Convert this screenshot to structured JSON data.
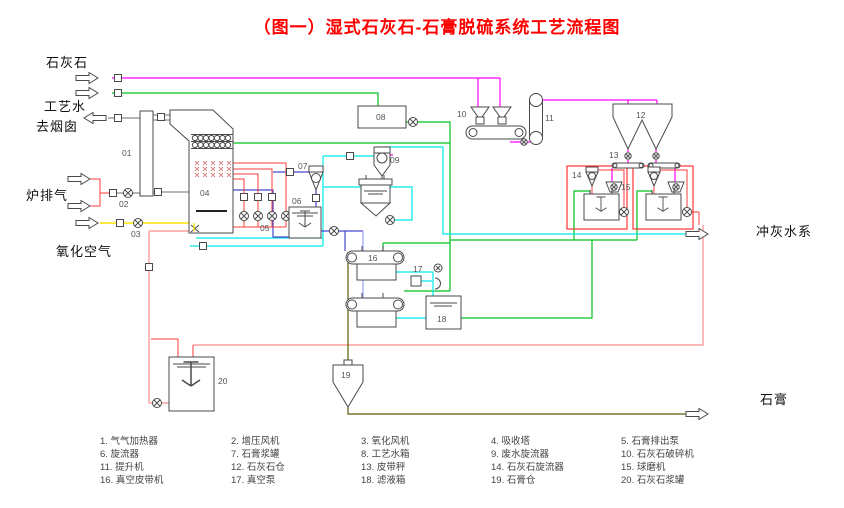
{
  "title": "（图一）湿式石灰石-石膏脱硫系统工艺流程图",
  "labels": {
    "limestone": "石灰石",
    "process_water": "工艺水",
    "to_chimney": "去烟囱",
    "furnace_exhaust": "炉排气",
    "oxidation_air": "氧化空气",
    "ash_water_system": "冲灰水系",
    "gypsum": "石膏"
  },
  "tags": {
    "t01": "01",
    "t02": "02",
    "t03": "03",
    "t04": "04",
    "t05": "05",
    "t06": "06",
    "t07": "07",
    "t08": "08",
    "t09": "09",
    "t10": "10",
    "t11": "11",
    "t12": "12",
    "t13": "13",
    "t14": "14",
    "t15": "15",
    "t16": "16",
    "t17": "17",
    "t18": "18",
    "t19": "19",
    "t20": "20"
  },
  "legend": {
    "items": [
      "1. 气气加热器",
      "2. 增压风机",
      "3. 氧化风机",
      "4. 吸收塔",
      "5. 石膏排出泵",
      "6. 旋流器",
      "7. 石膏浆罐",
      "8. 工艺水箱",
      "9. 废水旋流器",
      "10. 石灰石破碎机",
      "11. 提升机",
      "12. 石灰石仓",
      "13. 皮带秤",
      "14. 石灰石旋流器",
      "15. 球磨机",
      "16. 真空皮带机",
      "17. 真空泵",
      "18. 滤液箱",
      "19. 石膏仓",
      "20. 石灰石浆罐"
    ]
  },
  "colors": {
    "title_red": "#FF0000",
    "limestone_line": "#FF00FF",
    "process_water_line": "#00C020",
    "recycle_water_line": "#00E8E8",
    "slurry_line": "#4747D0",
    "oxidation_air_line": "#FFE400",
    "recirculation_line": "#FF3B3B",
    "slurry_feed_line": "#FF9E9E",
    "gypsum_cake_line": "#5A5A00",
    "flue_gas_line": "#8A8A8A"
  }
}
